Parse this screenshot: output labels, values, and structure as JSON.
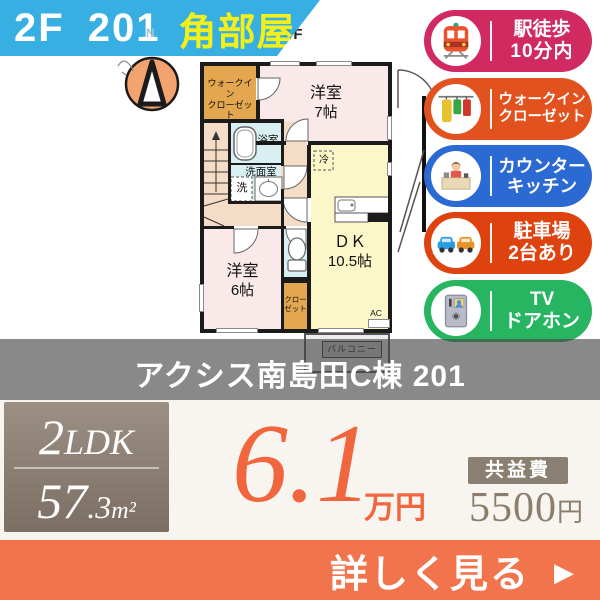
{
  "banner": {
    "unit": "2F 201",
    "corner": "角部屋"
  },
  "plan": {
    "floor": "2F",
    "north": "N",
    "wic1": "ウォークイン",
    "wic2": "クローゼット",
    "room7a": "洋室",
    "room7b": "7帖",
    "bath": "浴室",
    "wash_room": "洗面室",
    "washer": "洗",
    "fridge": "冷",
    "dk1": "ＤＫ",
    "dk2": "10.5帖",
    "room6a": "洋室",
    "room6b": "6帖",
    "closet1": "クロー",
    "closet2": "ゼット",
    "ac": "AC",
    "balcony": "バルコニー"
  },
  "features": [
    {
      "line1": "駅徒歩",
      "line2": "10分内",
      "color": "#d02a60",
      "icon": "train-icon"
    },
    {
      "line1": "ウォークイン",
      "line2": "クローゼット",
      "color": "#e2521e",
      "icon": "closet-icon"
    },
    {
      "line1": "カウンター",
      "line2": "キッチン",
      "color": "#2b69d3",
      "icon": "counter-kitchen-icon"
    },
    {
      "line1": "駐車場",
      "line2": "2台あり",
      "color": "#de430f",
      "icon": "parking-icon"
    },
    {
      "line1": "TV",
      "line2": "ドアホン",
      "color": "#27b562",
      "icon": "doorphone-icon"
    }
  ],
  "title": "アクシス南島田C棟 201",
  "summary": {
    "layout_num": "2",
    "layout_type": "LDK",
    "area_int": "57",
    "area_dec": ".3",
    "area_unit": "m²",
    "rent": "6.1",
    "rent_unit": "万円",
    "fee_label": "共益費",
    "fee_value": "5500",
    "fee_unit": "円"
  },
  "cta": {
    "label": "詳しく見る",
    "arrow": "▶"
  }
}
